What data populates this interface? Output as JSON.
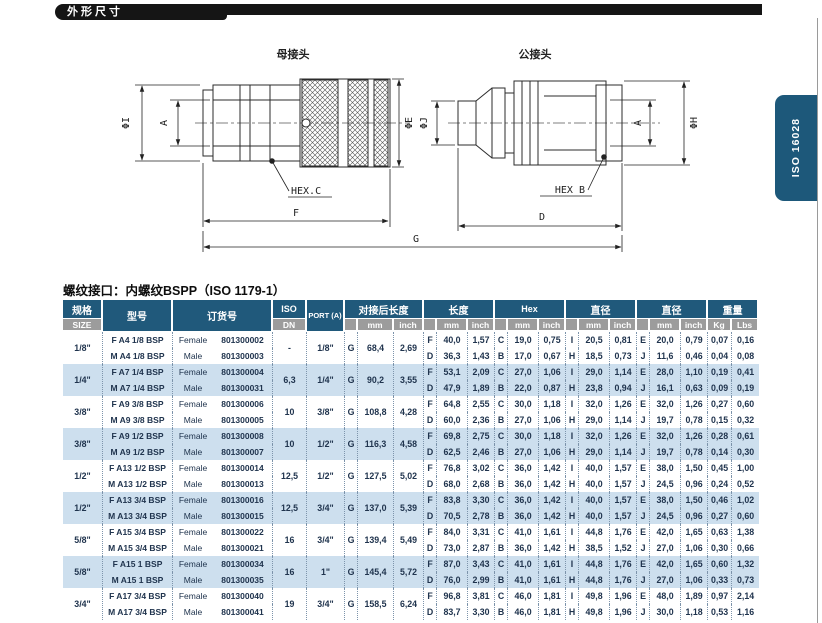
{
  "page": {
    "header_bar": "外形尺寸",
    "side_tab": "ISO 16028",
    "note": "螺纹接口：内螺纹BSPP（ISO 1179-1）"
  },
  "drawing": {
    "female_label": "母接头",
    "male_label": "公接头",
    "dims": {
      "phi_i": "ΦI",
      "a": "A",
      "phi_e": "ΦE",
      "phi_j": "ΦJ",
      "phi_h": "ΦH",
      "hex_c": "HEX.C",
      "hex_b": "HEX B",
      "f": "F",
      "d": "D",
      "g": "G"
    }
  },
  "table": {
    "headers": {
      "size_cn": "规格",
      "size_en": "SIZE",
      "model": "型号",
      "order": "订货号",
      "iso": "ISO",
      "dn": "DN",
      "port": "PORT (A)",
      "coupled_length": "对接后长度",
      "length": "长度",
      "hex": "Hex",
      "diameter": "直径",
      "weight": "重量",
      "mm": "mm",
      "inch": "inch",
      "kg": "Kg",
      "lbs": "Lbs"
    },
    "groups": [
      {
        "size": "1/8\"",
        "iso_dn": "-",
        "port": "1/8\"",
        "coupled": {
          "l": "G",
          "mm": "68,4",
          "inch": "2,69"
        },
        "rows": [
          {
            "model": "F A4 1/8 BSP",
            "gender": "Female",
            "order": "801300002",
            "len": {
              "l": "F",
              "mm": "40,0",
              "inch": "1,57"
            },
            "hex": {
              "l": "C",
              "mm": "19,0",
              "inch": "0,75"
            },
            "dia1": {
              "l": "I",
              "mm": "20,5",
              "inch": "0,81"
            },
            "dia2": {
              "l": "E",
              "mm": "20,0",
              "inch": "0,79"
            },
            "kg": "0,07",
            "lbs": "0,16"
          },
          {
            "model": "M A4 1/8 BSP",
            "gender": "Male",
            "order": "801300003",
            "len": {
              "l": "D",
              "mm": "36,3",
              "inch": "1,43"
            },
            "hex": {
              "l": "B",
              "mm": "17,0",
              "inch": "0,67"
            },
            "dia1": {
              "l": "H",
              "mm": "18,5",
              "inch": "0,73"
            },
            "dia2": {
              "l": "J",
              "mm": "11,6",
              "inch": "0,46"
            },
            "kg": "0,04",
            "lbs": "0,08"
          }
        ]
      },
      {
        "size": "1/4\"",
        "iso_dn": "6,3",
        "port": "1/4\"",
        "coupled": {
          "l": "G",
          "mm": "90,2",
          "inch": "3,55"
        },
        "rows": [
          {
            "model": "F A7 1/4 BSP",
            "gender": "Female",
            "order": "801300004",
            "len": {
              "l": "F",
              "mm": "53,1",
              "inch": "2,09"
            },
            "hex": {
              "l": "C",
              "mm": "27,0",
              "inch": "1,06"
            },
            "dia1": {
              "l": "I",
              "mm": "29,0",
              "inch": "1,14"
            },
            "dia2": {
              "l": "E",
              "mm": "28,0",
              "inch": "1,10"
            },
            "kg": "0,19",
            "lbs": "0,41"
          },
          {
            "model": "M A7 1/4 BSP",
            "gender": "Male",
            "order": "801300031",
            "len": {
              "l": "D",
              "mm": "47,9",
              "inch": "1,89"
            },
            "hex": {
              "l": "B",
              "mm": "22,0",
              "inch": "0,87"
            },
            "dia1": {
              "l": "H",
              "mm": "23,8",
              "inch": "0,94"
            },
            "dia2": {
              "l": "J",
              "mm": "16,1",
              "inch": "0,63"
            },
            "kg": "0,09",
            "lbs": "0,19"
          }
        ]
      },
      {
        "size": "3/8\"",
        "iso_dn": "10",
        "port": "3/8\"",
        "coupled": {
          "l": "G",
          "mm": "108,8",
          "inch": "4,28"
        },
        "rows": [
          {
            "model": "F A9 3/8 BSP",
            "gender": "Female",
            "order": "801300006",
            "len": {
              "l": "F",
              "mm": "64,8",
              "inch": "2,55"
            },
            "hex": {
              "l": "C",
              "mm": "30,0",
              "inch": "1,18"
            },
            "dia1": {
              "l": "I",
              "mm": "32,0",
              "inch": "1,26"
            },
            "dia2": {
              "l": "E",
              "mm": "32,0",
              "inch": "1,26"
            },
            "kg": "0,27",
            "lbs": "0,60"
          },
          {
            "model": "M A9 3/8 BSP",
            "gender": "Male",
            "order": "801300005",
            "len": {
              "l": "D",
              "mm": "60,0",
              "inch": "2,36"
            },
            "hex": {
              "l": "B",
              "mm": "27,0",
              "inch": "1,06"
            },
            "dia1": {
              "l": "H",
              "mm": "29,0",
              "inch": "1,14"
            },
            "dia2": {
              "l": "J",
              "mm": "19,7",
              "inch": "0,78"
            },
            "kg": "0,15",
            "lbs": "0,32"
          }
        ]
      },
      {
        "size": "3/8\"",
        "iso_dn": "10",
        "port": "1/2\"",
        "coupled": {
          "l": "G",
          "mm": "116,3",
          "inch": "4,58"
        },
        "rows": [
          {
            "model": "F A9 1/2 BSP",
            "gender": "Female",
            "order": "801300008",
            "len": {
              "l": "F",
              "mm": "69,8",
              "inch": "2,75"
            },
            "hex": {
              "l": "C",
              "mm": "30,0",
              "inch": "1,18"
            },
            "dia1": {
              "l": "I",
              "mm": "32,0",
              "inch": "1,26"
            },
            "dia2": {
              "l": "E",
              "mm": "32,0",
              "inch": "1,26"
            },
            "kg": "0,28",
            "lbs": "0,61"
          },
          {
            "model": "M A9 1/2 BSP",
            "gender": "Male",
            "order": "801300007",
            "len": {
              "l": "D",
              "mm": "62,5",
              "inch": "2,46"
            },
            "hex": {
              "l": "B",
              "mm": "27,0",
              "inch": "1,06"
            },
            "dia1": {
              "l": "H",
              "mm": "29,0",
              "inch": "1,14"
            },
            "dia2": {
              "l": "J",
              "mm": "19,7",
              "inch": "0,78"
            },
            "kg": "0,14",
            "lbs": "0,30"
          }
        ]
      },
      {
        "size": "1/2\"",
        "iso_dn": "12,5",
        "port": "1/2\"",
        "coupled": {
          "l": "G",
          "mm": "127,5",
          "inch": "5,02"
        },
        "rows": [
          {
            "model": "F A13 1/2 BSP",
            "gender": "Female",
            "order": "801300014",
            "len": {
              "l": "F",
              "mm": "76,8",
              "inch": "3,02"
            },
            "hex": {
              "l": "C",
              "mm": "36,0",
              "inch": "1,42"
            },
            "dia1": {
              "l": "I",
              "mm": "40,0",
              "inch": "1,57"
            },
            "dia2": {
              "l": "E",
              "mm": "38,0",
              "inch": "1,50"
            },
            "kg": "0,45",
            "lbs": "1,00"
          },
          {
            "model": "M A13 1/2 BSP",
            "gender": "Male",
            "order": "801300013",
            "len": {
              "l": "D",
              "mm": "68,0",
              "inch": "2,68"
            },
            "hex": {
              "l": "B",
              "mm": "36,0",
              "inch": "1,42"
            },
            "dia1": {
              "l": "H",
              "mm": "40,0",
              "inch": "1,57"
            },
            "dia2": {
              "l": "J",
              "mm": "24,5",
              "inch": "0,96"
            },
            "kg": "0,24",
            "lbs": "0,52"
          }
        ]
      },
      {
        "size": "1/2\"",
        "iso_dn": "12,5",
        "port": "3/4\"",
        "coupled": {
          "l": "G",
          "mm": "137,0",
          "inch": "5,39"
        },
        "rows": [
          {
            "model": "F A13 3/4 BSP",
            "gender": "Female",
            "order": "801300016",
            "len": {
              "l": "F",
              "mm": "83,8",
              "inch": "3,30"
            },
            "hex": {
              "l": "C",
              "mm": "36,0",
              "inch": "1,42"
            },
            "dia1": {
              "l": "I",
              "mm": "40,0",
              "inch": "1,57"
            },
            "dia2": {
              "l": "E",
              "mm": "38,0",
              "inch": "1,50"
            },
            "kg": "0,46",
            "lbs": "1,02"
          },
          {
            "model": "M A13 3/4 BSP",
            "gender": "Male",
            "order": "801300015",
            "len": {
              "l": "D",
              "mm": "70,5",
              "inch": "2,78"
            },
            "hex": {
              "l": "B",
              "mm": "36,0",
              "inch": "1,42"
            },
            "dia1": {
              "l": "H",
              "mm": "40,0",
              "inch": "1,57"
            },
            "dia2": {
              "l": "J",
              "mm": "24,5",
              "inch": "0,96"
            },
            "kg": "0,27",
            "lbs": "0,60"
          }
        ]
      },
      {
        "size": "5/8\"",
        "iso_dn": "16",
        "port": "3/4\"",
        "coupled": {
          "l": "G",
          "mm": "139,4",
          "inch": "5,49"
        },
        "rows": [
          {
            "model": "F A15 3/4 BSP",
            "gender": "Female",
            "order": "801300022",
            "len": {
              "l": "F",
              "mm": "84,0",
              "inch": "3,31"
            },
            "hex": {
              "l": "C",
              "mm": "41,0",
              "inch": "1,61"
            },
            "dia1": {
              "l": "I",
              "mm": "44,8",
              "inch": "1,76"
            },
            "dia2": {
              "l": "E",
              "mm": "42,0",
              "inch": "1,65"
            },
            "kg": "0,63",
            "lbs": "1,38"
          },
          {
            "model": "M A15 3/4 BSP",
            "gender": "Male",
            "order": "801300021",
            "len": {
              "l": "D",
              "mm": "73,0",
              "inch": "2,87"
            },
            "hex": {
              "l": "B",
              "mm": "36,0",
              "inch": "1,42"
            },
            "dia1": {
              "l": "H",
              "mm": "38,5",
              "inch": "1,52"
            },
            "dia2": {
              "l": "J",
              "mm": "27,0",
              "inch": "1,06"
            },
            "kg": "0,30",
            "lbs": "0,66"
          }
        ]
      },
      {
        "size": "5/8\"",
        "iso_dn": "16",
        "port": "1\"",
        "coupled": {
          "l": "G",
          "mm": "145,4",
          "inch": "5,72"
        },
        "rows": [
          {
            "model": "F A15 1 BSP",
            "gender": "Female",
            "order": "801300034",
            "len": {
              "l": "F",
              "mm": "87,0",
              "inch": "3,43"
            },
            "hex": {
              "l": "C",
              "mm": "41,0",
              "inch": "1,61"
            },
            "dia1": {
              "l": "I",
              "mm": "44,8",
              "inch": "1,76"
            },
            "dia2": {
              "l": "E",
              "mm": "42,0",
              "inch": "1,65"
            },
            "kg": "0,60",
            "lbs": "1,32"
          },
          {
            "model": "M A15 1 BSP",
            "gender": "Male",
            "order": "801300035",
            "len": {
              "l": "D",
              "mm": "76,0",
              "inch": "2,99"
            },
            "hex": {
              "l": "B",
              "mm": "41,0",
              "inch": "1,61"
            },
            "dia1": {
              "l": "H",
              "mm": "44,8",
              "inch": "1,76"
            },
            "dia2": {
              "l": "J",
              "mm": "27,0",
              "inch": "1,06"
            },
            "kg": "0,33",
            "lbs": "0,73"
          }
        ]
      },
      {
        "size": "3/4\"",
        "iso_dn": "19",
        "port": "3/4\"",
        "coupled": {
          "l": "G",
          "mm": "158,5",
          "inch": "6,24"
        },
        "rows": [
          {
            "model": "F A17 3/4 BSP",
            "gender": "Female",
            "order": "801300040",
            "len": {
              "l": "F",
              "mm": "96,8",
              "inch": "3,81"
            },
            "hex": {
              "l": "C",
              "mm": "46,0",
              "inch": "1,81"
            },
            "dia1": {
              "l": "I",
              "mm": "49,8",
              "inch": "1,96"
            },
            "dia2": {
              "l": "E",
              "mm": "48,0",
              "inch": "1,89"
            },
            "kg": "0,97",
            "lbs": "2,14"
          },
          {
            "model": "M A17 3/4 BSP",
            "gender": "Male",
            "order": "801300041",
            "len": {
              "l": "D",
              "mm": "83,7",
              "inch": "3,30"
            },
            "hex": {
              "l": "B",
              "mm": "46,0",
              "inch": "1,81"
            },
            "dia1": {
              "l": "H",
              "mm": "49,8",
              "inch": "1,96"
            },
            "dia2": {
              "l": "J",
              "mm": "30,0",
              "inch": "1,18"
            },
            "kg": "0,53",
            "lbs": "1,16"
          }
        ]
      }
    ]
  }
}
